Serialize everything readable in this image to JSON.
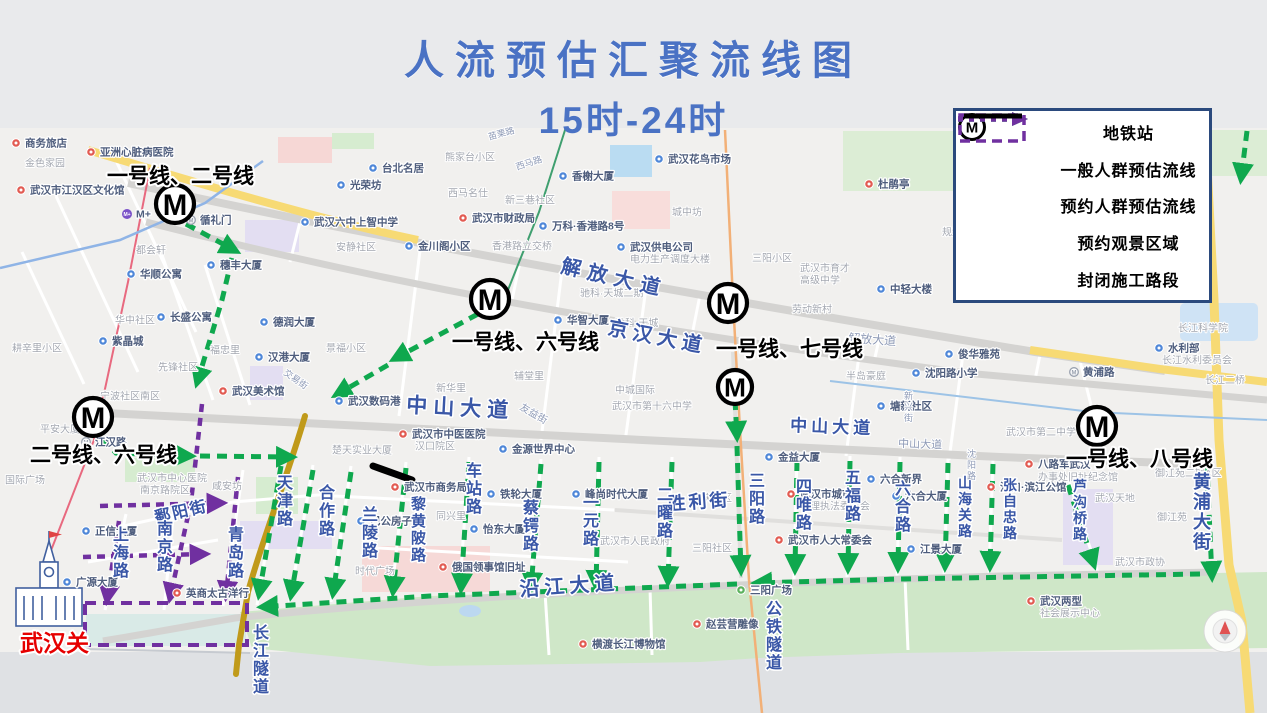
{
  "title": {
    "line1": "人流预估汇聚流线图",
    "line2": "15时-24时"
  },
  "colors": {
    "title": "#4a72c4",
    "general_flow_green": "#0fa84e",
    "reserved_flow_purple": "#7030a0",
    "construction_black": "#000000",
    "street_label_blue": "#3a57a7",
    "legend_border": "#2b4a7d",
    "landmark_red": "#e60000"
  },
  "legend": {
    "items": [
      {
        "symbol": "metro-icon",
        "label": "地铁站"
      },
      {
        "symbol": "green-dotted-arrow",
        "label": "一般人群预估流线"
      },
      {
        "symbol": "purple-dotted-arrow",
        "label": "预约人群预估流线"
      },
      {
        "symbol": "purple-dashed-rect",
        "label": "预约观景区域"
      },
      {
        "symbol": "black-solid-line",
        "label": "封闭施工路段"
      }
    ]
  },
  "landmark": {
    "label": "武汉关"
  },
  "map": {
    "stations": [
      {
        "x": 175,
        "y": 204,
        "r": 19
      },
      {
        "x": 490,
        "y": 299,
        "r": 19
      },
      {
        "x": 728,
        "y": 303,
        "r": 19
      },
      {
        "x": 735,
        "y": 387,
        "r": 17
      },
      {
        "x": 93,
        "y": 417,
        "r": 19
      },
      {
        "x": 1097,
        "y": 426,
        "r": 19
      }
    ],
    "station_labels": [
      {
        "t": "一号线、二号线",
        "x": 107,
        "y": 183
      },
      {
        "t": "一号线、六号线",
        "x": 452,
        "y": 349
      },
      {
        "t": "一号线、七号线",
        "x": 716,
        "y": 356
      },
      {
        "t": "二号线、六号线",
        "x": 30,
        "y": 462
      },
      {
        "t": "一号线、八号线",
        "x": 1066,
        "y": 466
      }
    ],
    "street_labels": [
      {
        "t": "解放大道",
        "x": 560,
        "y": 272,
        "s": 20,
        "r": 13,
        "ls": 7
      },
      {
        "t": "解放大道",
        "x": 848,
        "y": 342,
        "s": 12,
        "r": 4,
        "m": true
      },
      {
        "t": "京汉大道",
        "x": 607,
        "y": 334,
        "s": 20,
        "r": 11,
        "ls": 5
      },
      {
        "t": "中山大道",
        "x": 406,
        "y": 412,
        "s": 21,
        "r": 3,
        "ls": 6
      },
      {
        "t": "中山大道",
        "x": 790,
        "y": 431,
        "s": 17,
        "r": 2,
        "ls": 4
      },
      {
        "t": "中山大道",
        "x": 898,
        "y": 447,
        "s": 11,
        "r": 2,
        "m": true
      },
      {
        "t": "沿江大道",
        "x": 520,
        "y": 596,
        "s": 20,
        "r": -4,
        "ls": 5
      },
      {
        "t": "胜利街",
        "x": 668,
        "y": 510,
        "s": 18,
        "r": -4,
        "ls": 3
      },
      {
        "t": "鄱阳街",
        "x": 156,
        "y": 523,
        "s": 16,
        "r": -13,
        "ls": 2
      },
      {
        "t": "黄浦大街",
        "x": 1193,
        "y": 470,
        "s": 18,
        "v": true
      },
      {
        "t": "长江隧道",
        "x": 253,
        "y": 622,
        "s": 16,
        "v": true
      },
      {
        "t": "公铁隧道",
        "x": 766,
        "y": 598,
        "s": 16,
        "v": true
      },
      {
        "t": "上海路",
        "x": 113,
        "y": 524,
        "s": 16,
        "v": true
      },
      {
        "t": "南京路",
        "x": 157,
        "y": 518,
        "s": 16,
        "v": true
      },
      {
        "t": "青岛路",
        "x": 228,
        "y": 524,
        "s": 16,
        "v": true
      },
      {
        "t": "天津路",
        "x": 277,
        "y": 472,
        "s": 16,
        "v": true
      },
      {
        "t": "合作路",
        "x": 319,
        "y": 482,
        "s": 16,
        "v": true
      },
      {
        "t": "兰陵路",
        "x": 362,
        "y": 504,
        "s": 16,
        "v": true
      },
      {
        "t": "黎黄陂路",
        "x": 411,
        "y": 494,
        "s": 15,
        "v": true
      },
      {
        "t": "车站路",
        "x": 466,
        "y": 460,
        "s": 16,
        "v": true
      },
      {
        "t": "蔡锷路",
        "x": 523,
        "y": 497,
        "s": 16,
        "v": true
      },
      {
        "t": "一元路",
        "x": 583,
        "y": 492,
        "s": 16,
        "v": true
      },
      {
        "t": "二曜路",
        "x": 657,
        "y": 484,
        "s": 16,
        "v": true
      },
      {
        "t": "三阳路",
        "x": 749,
        "y": 470,
        "s": 16,
        "v": true
      },
      {
        "t": "四唯路",
        "x": 796,
        "y": 476,
        "s": 16,
        "v": true
      },
      {
        "t": "五福路",
        "x": 845,
        "y": 467,
        "s": 16,
        "v": true
      },
      {
        "t": "六合路",
        "x": 895,
        "y": 478,
        "s": 16,
        "v": true
      },
      {
        "t": "山海关路",
        "x": 958,
        "y": 474,
        "s": 14,
        "v": true
      },
      {
        "t": "张自忠路",
        "x": 1003,
        "y": 476,
        "s": 14,
        "v": true
      },
      {
        "t": "芦沟桥路",
        "x": 1073,
        "y": 477,
        "s": 14,
        "v": true
      },
      {
        "t": "沈阳路",
        "x": 967,
        "y": 448,
        "s": 9,
        "v": true,
        "m": true
      },
      {
        "t": "新兴街",
        "x": 904,
        "y": 390,
        "s": 9,
        "v": true,
        "m": true
      },
      {
        "t": "交易街",
        "x": 283,
        "y": 374,
        "s": 9,
        "r": 35,
        "m": true
      },
      {
        "t": "友益街",
        "x": 519,
        "y": 409,
        "s": 10,
        "r": 30,
        "m": true
      },
      {
        "t": "苗栗路",
        "x": 489,
        "y": 140,
        "s": 9,
        "r": -15,
        "m": true
      },
      {
        "t": "西马路",
        "x": 517,
        "y": 170,
        "s": 9,
        "r": -18,
        "m": true
      }
    ],
    "pois": [
      {
        "t": "商务旅店",
        "x": 25,
        "y": 143,
        "p": "red"
      },
      {
        "t": "金色家园",
        "x": 25,
        "y": 163,
        "m": true
      },
      {
        "t": "亚洲心脏病医院",
        "x": 100,
        "y": 152,
        "p": "red"
      },
      {
        "t": "武汉市江汉区文化馆",
        "x": 30,
        "y": 190,
        "p": "red"
      },
      {
        "t": "都会轩",
        "x": 136,
        "y": 250,
        "m": true
      },
      {
        "t": "华顺公寓",
        "x": 140,
        "y": 274,
        "p": "blue"
      },
      {
        "t": "长盛公寓",
        "x": 170,
        "y": 317,
        "p": "blue"
      },
      {
        "t": "华中社区",
        "x": 115,
        "y": 320,
        "m": true
      },
      {
        "t": "紫晶城",
        "x": 112,
        "y": 341,
        "p": "blue"
      },
      {
        "t": "耕辛里小区",
        "x": 12,
        "y": 348,
        "m": true
      },
      {
        "t": "先锋社区",
        "x": 158,
        "y": 367,
        "m": true
      },
      {
        "t": "平安大厦",
        "x": 40,
        "y": 429,
        "m": true
      },
      {
        "t": "宁波社区南区",
        "x": 100,
        "y": 396,
        "m": true
      },
      {
        "t": "国际广场",
        "x": 5,
        "y": 480,
        "m": true
      },
      {
        "t": "武汉美术馆",
        "x": 232,
        "y": 391,
        "p": "red"
      },
      {
        "t": "江汉路",
        "x": 95,
        "y": 442,
        "p": "metro"
      },
      {
        "t": "武汉市中心医院",
        "x": 137,
        "y": 478,
        "m": true
      },
      {
        "t": "南京路院区",
        "x": 140,
        "y": 490,
        "m": true
      },
      {
        "t": "咸安坊",
        "x": 212,
        "y": 486,
        "m": true
      },
      {
        "t": "正信大厦",
        "x": 95,
        "y": 531,
        "p": "blue"
      },
      {
        "t": "广源大厦",
        "x": 76,
        "y": 582,
        "p": "blue"
      },
      {
        "t": "英商太古洋行",
        "x": 186,
        "y": 593,
        "p": "red"
      },
      {
        "t": "武汉市中医医院",
        "x": 412,
        "y": 434,
        "p": "red"
      },
      {
        "t": "汉口院区",
        "x": 415,
        "y": 446,
        "m": true
      },
      {
        "t": "武汉市商务局",
        "x": 404,
        "y": 487,
        "p": "red"
      },
      {
        "t": "楚天实业大厦",
        "x": 332,
        "y": 450,
        "m": true
      },
      {
        "t": "巴公房子",
        "x": 370,
        "y": 521,
        "p": "blue"
      },
      {
        "t": "同兴里",
        "x": 436,
        "y": 516,
        "m": true
      },
      {
        "t": "时代广场",
        "x": 355,
        "y": 571,
        "m": true
      },
      {
        "t": "俄国领事馆旧址",
        "x": 452,
        "y": 567,
        "p": "red"
      },
      {
        "t": "金源世界中心",
        "x": 512,
        "y": 449,
        "p": "blue"
      },
      {
        "t": "铁轮大厦",
        "x": 500,
        "y": 494,
        "p": "blue"
      },
      {
        "t": "怡东大厦",
        "x": 483,
        "y": 529,
        "p": "blue"
      },
      {
        "t": "峰尚时代大厦",
        "x": 585,
        "y": 494,
        "p": "blue"
      },
      {
        "t": "武汉市人民政府",
        "x": 600,
        "y": 541,
        "m": true
      },
      {
        "t": "延庆小区",
        "x": 692,
        "y": 498,
        "m": true
      },
      {
        "t": "三阳社区",
        "x": 692,
        "y": 548,
        "m": true
      },
      {
        "t": "三阳广场",
        "x": 750,
        "y": 590,
        "p": "green"
      },
      {
        "t": "武汉市人大常委会",
        "x": 788,
        "y": 540,
        "p": "red"
      },
      {
        "t": "武汉市城市",
        "x": 800,
        "y": 494,
        "p": "red"
      },
      {
        "t": "管理执法委员会",
        "x": 800,
        "y": 506,
        "m": true
      },
      {
        "t": "金益大厦",
        "x": 778,
        "y": 457,
        "p": "blue"
      },
      {
        "t": "六合新界",
        "x": 880,
        "y": 479,
        "p": "blue"
      },
      {
        "t": "六合大厦",
        "x": 905,
        "y": 496,
        "p": "blue"
      },
      {
        "t": "江景大厦",
        "x": 920,
        "y": 549,
        "p": "blue"
      },
      {
        "t": "汉口·滨江公馆",
        "x": 1000,
        "y": 487,
        "p": "red"
      },
      {
        "t": "八路军武汉",
        "x": 1038,
        "y": 464,
        "p": "red"
      },
      {
        "t": "办事处旧址纪念馆",
        "x": 1038,
        "y": 477,
        "m": true
      },
      {
        "t": "武汉天地",
        "x": 1095,
        "y": 498,
        "m": true
      },
      {
        "t": "御江苑二期A区",
        "x": 1155,
        "y": 473,
        "m": true
      },
      {
        "t": "御江苑",
        "x": 1157,
        "y": 517,
        "m": true
      },
      {
        "t": "武汉市政协",
        "x": 1115,
        "y": 562,
        "m": true
      },
      {
        "t": "武汉两型",
        "x": 1040,
        "y": 601,
        "p": "red"
      },
      {
        "t": "社会展示中心",
        "x": 1040,
        "y": 613,
        "m": true
      },
      {
        "t": "赵芸营雕像",
        "x": 706,
        "y": 624,
        "p": "red"
      },
      {
        "t": "横渡长江博物馆",
        "x": 592,
        "y": 644,
        "p": "red"
      },
      {
        "t": "台北名居",
        "x": 382,
        "y": 168,
        "p": "blue"
      },
      {
        "t": "光荣坊",
        "x": 350,
        "y": 185,
        "p": "blue"
      },
      {
        "t": "武汉六中上智中学",
        "x": 314,
        "y": 222,
        "p": "blue"
      },
      {
        "t": "安静社区",
        "x": 336,
        "y": 247,
        "m": true
      },
      {
        "t": "金川阁小区",
        "x": 418,
        "y": 246,
        "p": "blue"
      },
      {
        "t": "香港路立交桥",
        "x": 492,
        "y": 246,
        "m": true
      },
      {
        "t": "武汉市财政局",
        "x": 472,
        "y": 218,
        "p": "red"
      },
      {
        "t": "万科·香港路8号",
        "x": 552,
        "y": 226,
        "p": "blue"
      },
      {
        "t": "西马名仕",
        "x": 448,
        "y": 193,
        "m": true
      },
      {
        "t": "新三巷社区",
        "x": 505,
        "y": 200,
        "m": true
      },
      {
        "t": "熊家台小区",
        "x": 445,
        "y": 157,
        "m": true
      },
      {
        "t": "香榭大厦",
        "x": 572,
        "y": 176,
        "p": "blue"
      },
      {
        "t": "武汉花鸟市场",
        "x": 668,
        "y": 159,
        "p": "blue"
      },
      {
        "t": "武汉供电公司",
        "x": 630,
        "y": 247,
        "p": "blue"
      },
      {
        "t": "电力生产调度大楼",
        "x": 630,
        "y": 259,
        "m": true
      },
      {
        "t": "三阳小区",
        "x": 752,
        "y": 258,
        "m": true
      },
      {
        "t": "武汉市育才",
        "x": 800,
        "y": 268,
        "m": true
      },
      {
        "t": "高级中学",
        "x": 800,
        "y": 280,
        "m": true
      },
      {
        "t": "劳动新村",
        "x": 792,
        "y": 309,
        "m": true
      },
      {
        "t": "中轻大楼",
        "x": 890,
        "y": 289,
        "p": "blue"
      },
      {
        "t": "规划土地局宿舍",
        "x": 942,
        "y": 232,
        "m": true
      },
      {
        "t": "城中坊",
        "x": 672,
        "y": 212,
        "m": true
      },
      {
        "t": "俊华雅苑",
        "x": 958,
        "y": 354,
        "p": "blue"
      },
      {
        "t": "沈阳路小学",
        "x": 925,
        "y": 373,
        "p": "blue"
      },
      {
        "t": "半岛豪庭",
        "x": 846,
        "y": 376,
        "m": true
      },
      {
        "t": "塘新社区",
        "x": 890,
        "y": 406,
        "p": "blue"
      },
      {
        "t": "武汉市第二中学",
        "x": 1006,
        "y": 432,
        "m": true
      },
      {
        "t": "黄浦路",
        "x": 1083,
        "y": 372,
        "p": "metro"
      },
      {
        "t": "武汉市第十六中学",
        "x": 612,
        "y": 406,
        "m": true
      },
      {
        "t": "武汉数码港",
        "x": 348,
        "y": 401,
        "p": "blue"
      },
      {
        "t": "德润大厦",
        "x": 273,
        "y": 322,
        "p": "blue"
      },
      {
        "t": "汉港大厦",
        "x": 268,
        "y": 357,
        "p": "blue"
      },
      {
        "t": "景福小区",
        "x": 326,
        "y": 348,
        "m": true
      },
      {
        "t": "福忠里",
        "x": 210,
        "y": 350,
        "m": true
      },
      {
        "t": "穗丰大厦",
        "x": 220,
        "y": 265,
        "p": "blue"
      },
      {
        "t": "循礼门",
        "x": 200,
        "y": 220,
        "p": "metro"
      },
      {
        "t": "新华里",
        "x": 436,
        "y": 388,
        "m": true
      },
      {
        "t": "辅堂里",
        "x": 514,
        "y": 376,
        "m": true
      },
      {
        "t": "中城国际",
        "x": 615,
        "y": 390,
        "m": true
      },
      {
        "t": "华智大厦",
        "x": 567,
        "y": 320,
        "p": "blue"
      },
      {
        "t": "驰科·天城",
        "x": 615,
        "y": 323,
        "m": true
      },
      {
        "t": "驰科·天城二期",
        "x": 580,
        "y": 293,
        "m": true
      },
      {
        "t": "杜鹃亭",
        "x": 878,
        "y": 184,
        "p": "red"
      },
      {
        "t": "长江科学院",
        "x": 1178,
        "y": 328,
        "m": true
      },
      {
        "t": "水利部",
        "x": 1168,
        "y": 348,
        "p": "blue"
      },
      {
        "t": "长江水利委员会",
        "x": 1162,
        "y": 360,
        "m": true
      },
      {
        "t": "长江二桥",
        "x": 1205,
        "y": 380,
        "m": true
      },
      {
        "t": "M+",
        "x": 136,
        "y": 214,
        "p": "mplus"
      }
    ]
  }
}
